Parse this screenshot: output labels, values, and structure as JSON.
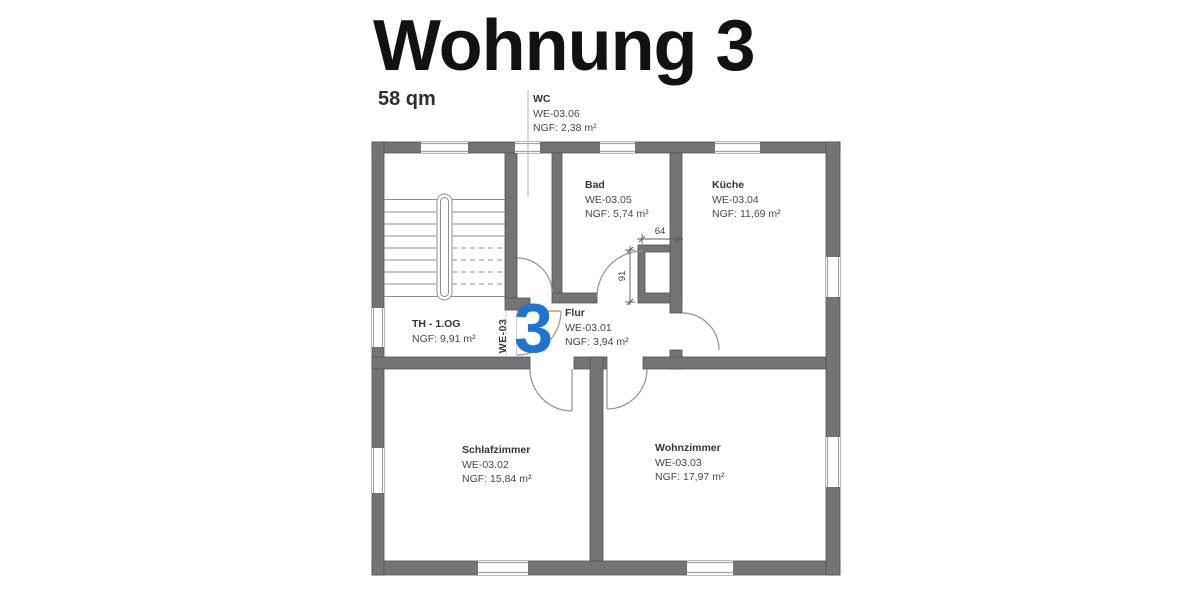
{
  "header": {
    "title": "Wohnung 3",
    "area": "58 qm"
  },
  "plan": {
    "apartment_number": "3",
    "apartment_code": "WE-03",
    "rooms": {
      "wc": {
        "name": "WC",
        "code": "WE-03.06",
        "ngf": "NGF: 2,38 m²"
      },
      "bad": {
        "name": "Bad",
        "code": "WE-03.05",
        "ngf": "NGF: 5,74 m²"
      },
      "kueche": {
        "name": "Küche",
        "code": "WE-03.04",
        "ngf": "NGF: 11,69 m²"
      },
      "treppenhaus": {
        "name": "TH - 1.OG",
        "ngf": "NGF: 9,91 m²"
      },
      "flur": {
        "name": "Flur",
        "code": "WE-03.01",
        "ngf": "NGF: 3,94 m²"
      },
      "schlafzimmer": {
        "name": "Schlafzimmer",
        "code": "WE-03.02",
        "ngf": "NGF: 15,84 m²"
      },
      "wohnzimmer": {
        "name": "Wohnzimmer",
        "code": "WE-03.03",
        "ngf": "NGF: 17,97 m²"
      }
    },
    "dimensions": {
      "shaft_width_cm": "64",
      "shaft_depth_cm": "91"
    },
    "colors": {
      "accent_blue": "#1a75d2",
      "wall_gray": "#747474",
      "entrance_door_tan": "#c49a6c"
    }
  }
}
